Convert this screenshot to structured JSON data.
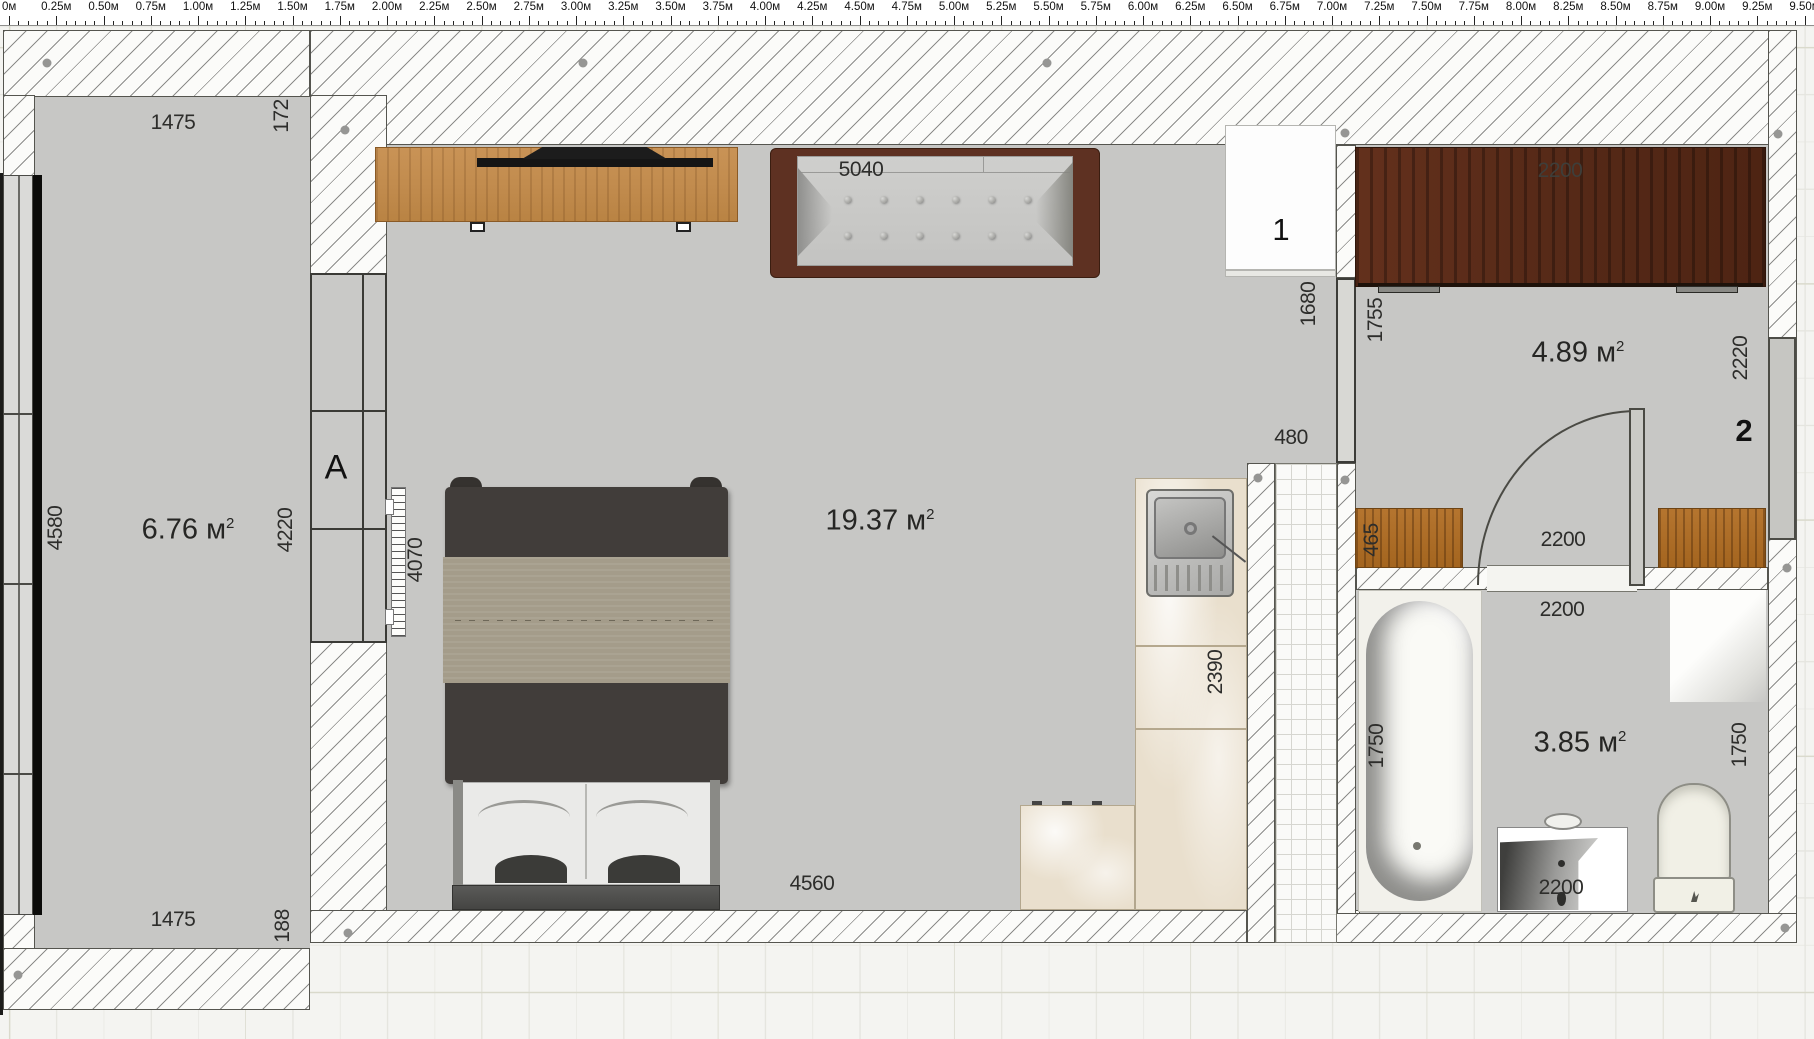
{
  "ruler": {
    "labels": [
      "0м",
      "0.25м",
      "0.50м",
      "0.75м",
      "1.00м",
      "1.25м",
      "1.50м",
      "1.75м",
      "2.00м",
      "2.25м",
      "2.50м",
      "2.75м",
      "3.00м",
      "3.25м",
      "3.50м",
      "3.75м",
      "4.00м",
      "4.25м",
      "4.50м",
      "4.75м",
      "5.00м",
      "5.25м",
      "5.50м",
      "5.75м",
      "6.00м",
      "6.25м",
      "6.50м",
      "6.75м",
      "7.00м",
      "7.25м",
      "7.50м",
      "7.75м",
      "8.00м",
      "8.25м",
      "8.50м",
      "8.75м",
      "9.00м",
      "9.25м",
      "9.50м"
    ]
  },
  "balcony": {
    "area": "6.76",
    "area_unit": "м",
    "area_sup": "2",
    "dim_top": "1475",
    "dim_wall": "172",
    "dim_left": "4580",
    "dim_right": "4220",
    "dim_bottom": "1475",
    "dim_wall_bottom": "188",
    "window_label": "A"
  },
  "living": {
    "area": "19.37",
    "area_unit": "м",
    "area_sup": "2",
    "dim_sofa": "5040",
    "dim_bottom": "4560",
    "dim_side": "4070",
    "dim_wall": "1680",
    "dim_opening": "480",
    "dim_counter": "2390",
    "door_label": "1"
  },
  "hallway": {
    "area": "4.89",
    "area_unit": "м",
    "area_sup": "2",
    "dim_wardrobe": "2200",
    "dim_left": "1755",
    "dim_right": "2220",
    "dim_cabinet": "465",
    "dim_door": "2200",
    "door_label": "2"
  },
  "bathroom": {
    "area": "3.85",
    "area_unit": "м",
    "area_sup": "2",
    "dim_top": "2200",
    "dim_tub": "1750",
    "dim_right": "1750",
    "dim_vanity": "2200"
  },
  "colors": {
    "floor": "#c7c7c5",
    "wall_edge": "#55554f",
    "wardrobe_wood": "#572a18",
    "stand_wood": "#c08a4c",
    "cabinet_wood": "#a4651f",
    "sofa_frame": "#5e3122",
    "counter": "#e9dfcd",
    "background": "#f4f4f1"
  }
}
